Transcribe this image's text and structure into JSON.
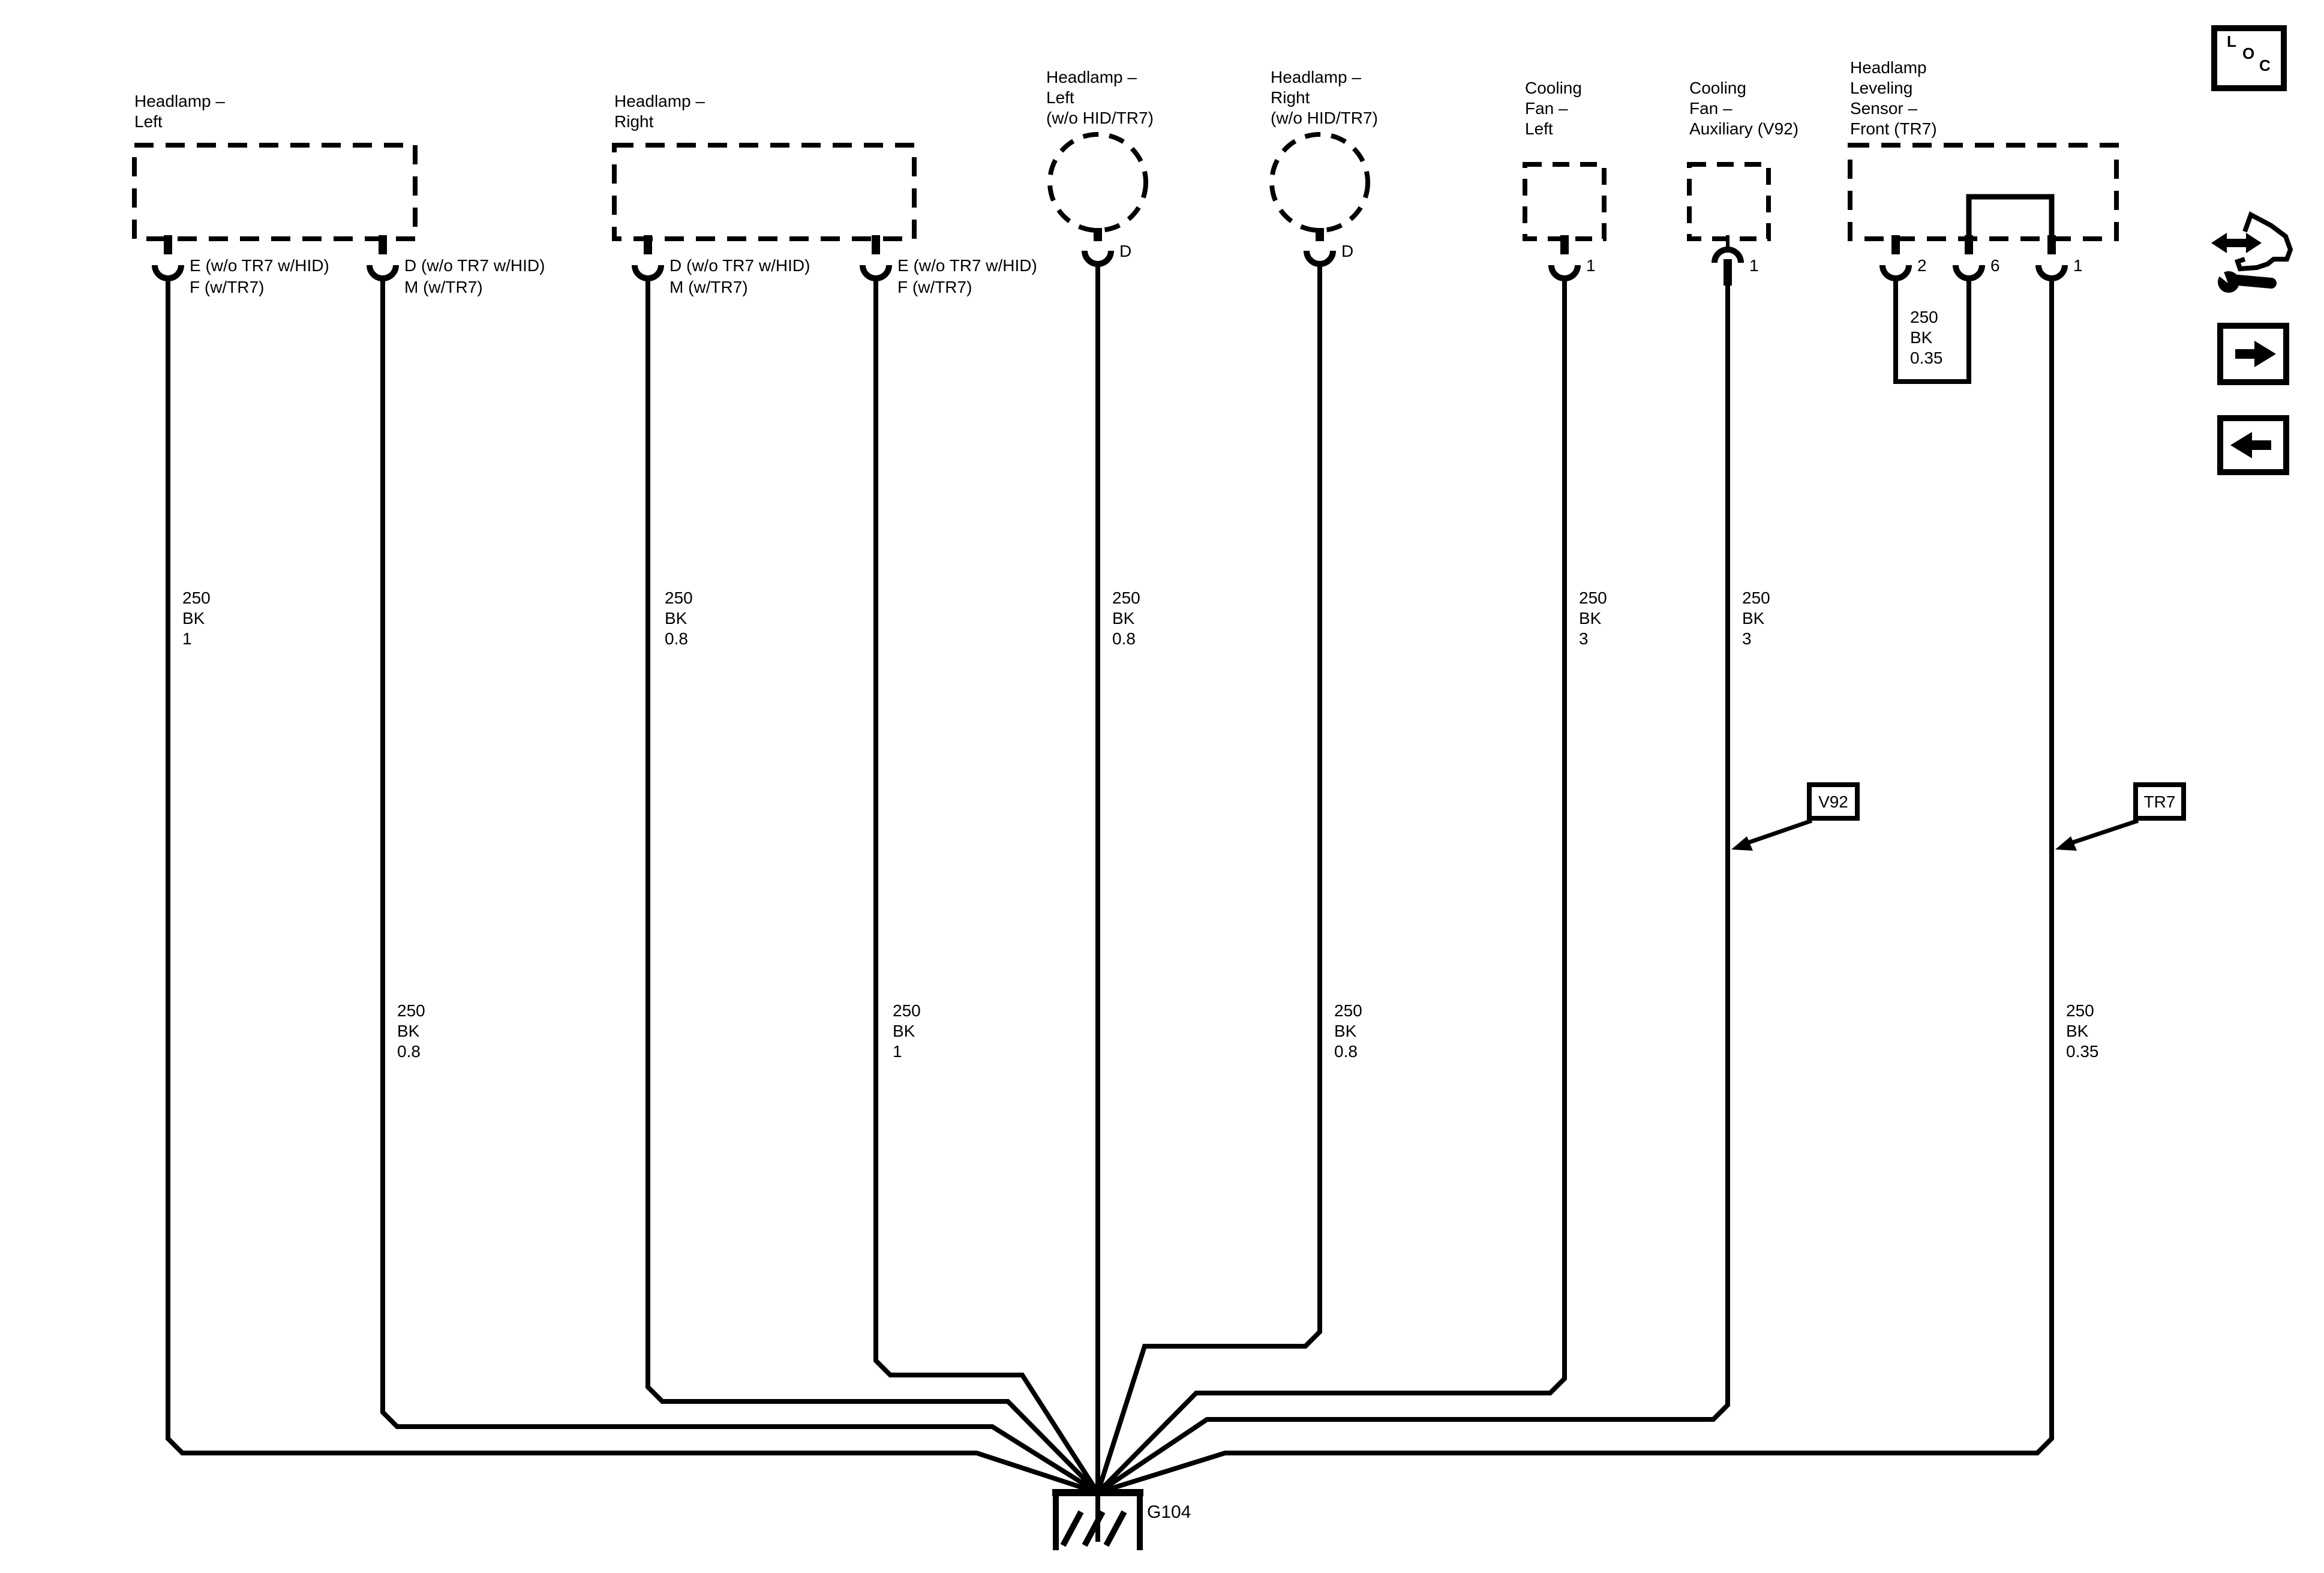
{
  "diagram": {
    "components": [
      {
        "name": "headlamp-left",
        "label": "Headlamp –\nLeft",
        "pins": [
          {
            "label": "E (w/o TR7 w/HID)\nF (w/TR7)"
          },
          {
            "label": "D (w/o TR7 w/HID)\nM (w/TR7)"
          }
        ]
      },
      {
        "name": "headlamp-right",
        "label": "Headlamp –\nRight",
        "pins": [
          {
            "label": "D (w/o TR7 w/HID)\nM (w/TR7)"
          },
          {
            "label": "E (w/o TR7 w/HID)\nF (w/TR7)"
          }
        ]
      },
      {
        "name": "headlamp-left-wo-hid-tr7",
        "label": "Headlamp –\nLeft\n(w/o HID/TR7)",
        "pins": [
          {
            "label": "D"
          }
        ]
      },
      {
        "name": "headlamp-right-wo-hid-tr7",
        "label": "Headlamp –\nRight\n(w/o HID/TR7)",
        "pins": [
          {
            "label": "D"
          }
        ]
      },
      {
        "name": "cooling-fan-left",
        "label": "Cooling\nFan –\nLeft",
        "pins": [
          {
            "label": "1"
          }
        ]
      },
      {
        "name": "cooling-fan-auxiliary",
        "label": "Cooling\nFan –\nAuxiliary (V92)",
        "pins": [
          {
            "label": "1"
          }
        ]
      },
      {
        "name": "headlamp-leveling-sensor-front",
        "label": "Headlamp\nLeveling\nSensor –\nFront (TR7)",
        "pins": [
          {
            "label": "2"
          },
          {
            "label": "6"
          },
          {
            "label": "1"
          }
        ]
      }
    ],
    "wires": [
      {
        "name": "headlamp-left-pin-e-wire",
        "label": "250\nBK\n1"
      },
      {
        "name": "headlamp-left-pin-d-wire",
        "label": "250\nBK\n0.8"
      },
      {
        "name": "headlamp-right-pin-d-wire",
        "label": "250\nBK\n0.8"
      },
      {
        "name": "headlamp-right-pin-e-wire",
        "label": "250\nBK\n1"
      },
      {
        "name": "headlamp-left-circle-pin-d-wire",
        "label": "250\nBK\n0.8"
      },
      {
        "name": "headlamp-right-circle-pin-d-wire",
        "label": "250\nBK\n0.8"
      },
      {
        "name": "cooling-fan-left-pin-1-wire",
        "label": "250\nBK\n3"
      },
      {
        "name": "cooling-fan-aux-pin-1-wire",
        "label": "250\nBK\n3"
      },
      {
        "name": "leveling-sensor-pin-1-wire",
        "label": "250\nBK\n0.35"
      },
      {
        "name": "leveling-sensor-pin2-pin6-jumper",
        "label": "250\nBK\n0.35"
      }
    ],
    "callouts": [
      {
        "label": "V92"
      },
      {
        "label": "TR7"
      }
    ],
    "ground": {
      "label": "G104"
    }
  },
  "toolbar": {
    "loc_letters": [
      "L",
      "O",
      "C"
    ]
  }
}
